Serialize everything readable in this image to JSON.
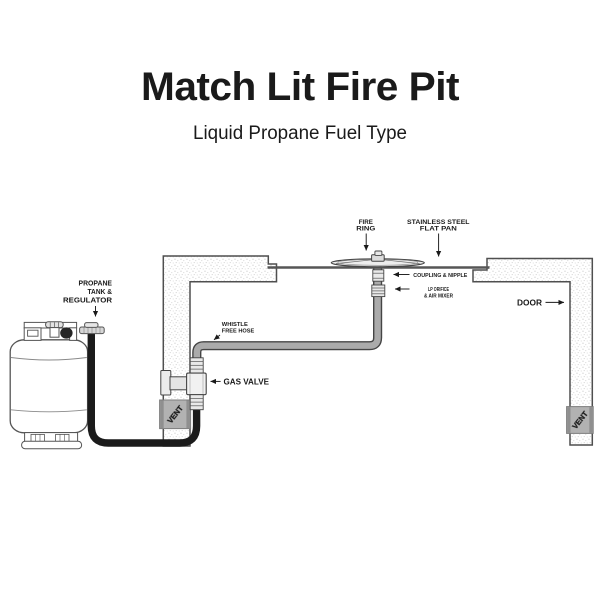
{
  "title": "Match Lit Fire Pit",
  "subtitle": "Liquid Propane Fuel Type",
  "callouts": {
    "propane_tank": {
      "line1": "PROPANE",
      "line2": "TANK &",
      "line3": "REGULATOR"
    },
    "whistle_hose": {
      "line1": "WHISTLE",
      "line2": "FREE HOSE"
    },
    "gas_valve": {
      "label": "GAS VALVE"
    },
    "fire_ring": {
      "line1": "FIRE",
      "line2": "RING"
    },
    "flat_pan": {
      "line1": "STAINLESS STEEL",
      "line2": "FLAT PAN"
    },
    "coupling": {
      "label": "COUPLING & NIPPLE"
    },
    "lp_orifice": {
      "line1": "LP ORIFICE",
      "line2": "& AIR MIXER"
    },
    "door": {
      "label": "DOOR"
    },
    "vent_left": {
      "label": "VENT"
    },
    "vent_right": {
      "label": "VENT"
    }
  },
  "colors": {
    "background": "#ffffff",
    "text": "#1a1a1a",
    "wall_outline": "#4f4f4f",
    "hose_black": "#1b1b1b",
    "hose_gray": "#ababab",
    "hose_edge": "#454545",
    "fitting_fill": "#e9e9e9",
    "vent_fill": "#b2b2b2",
    "vent_edge": "#8f8f8f",
    "vent_text": "#ffffff",
    "pan_line": "#565656"
  }
}
